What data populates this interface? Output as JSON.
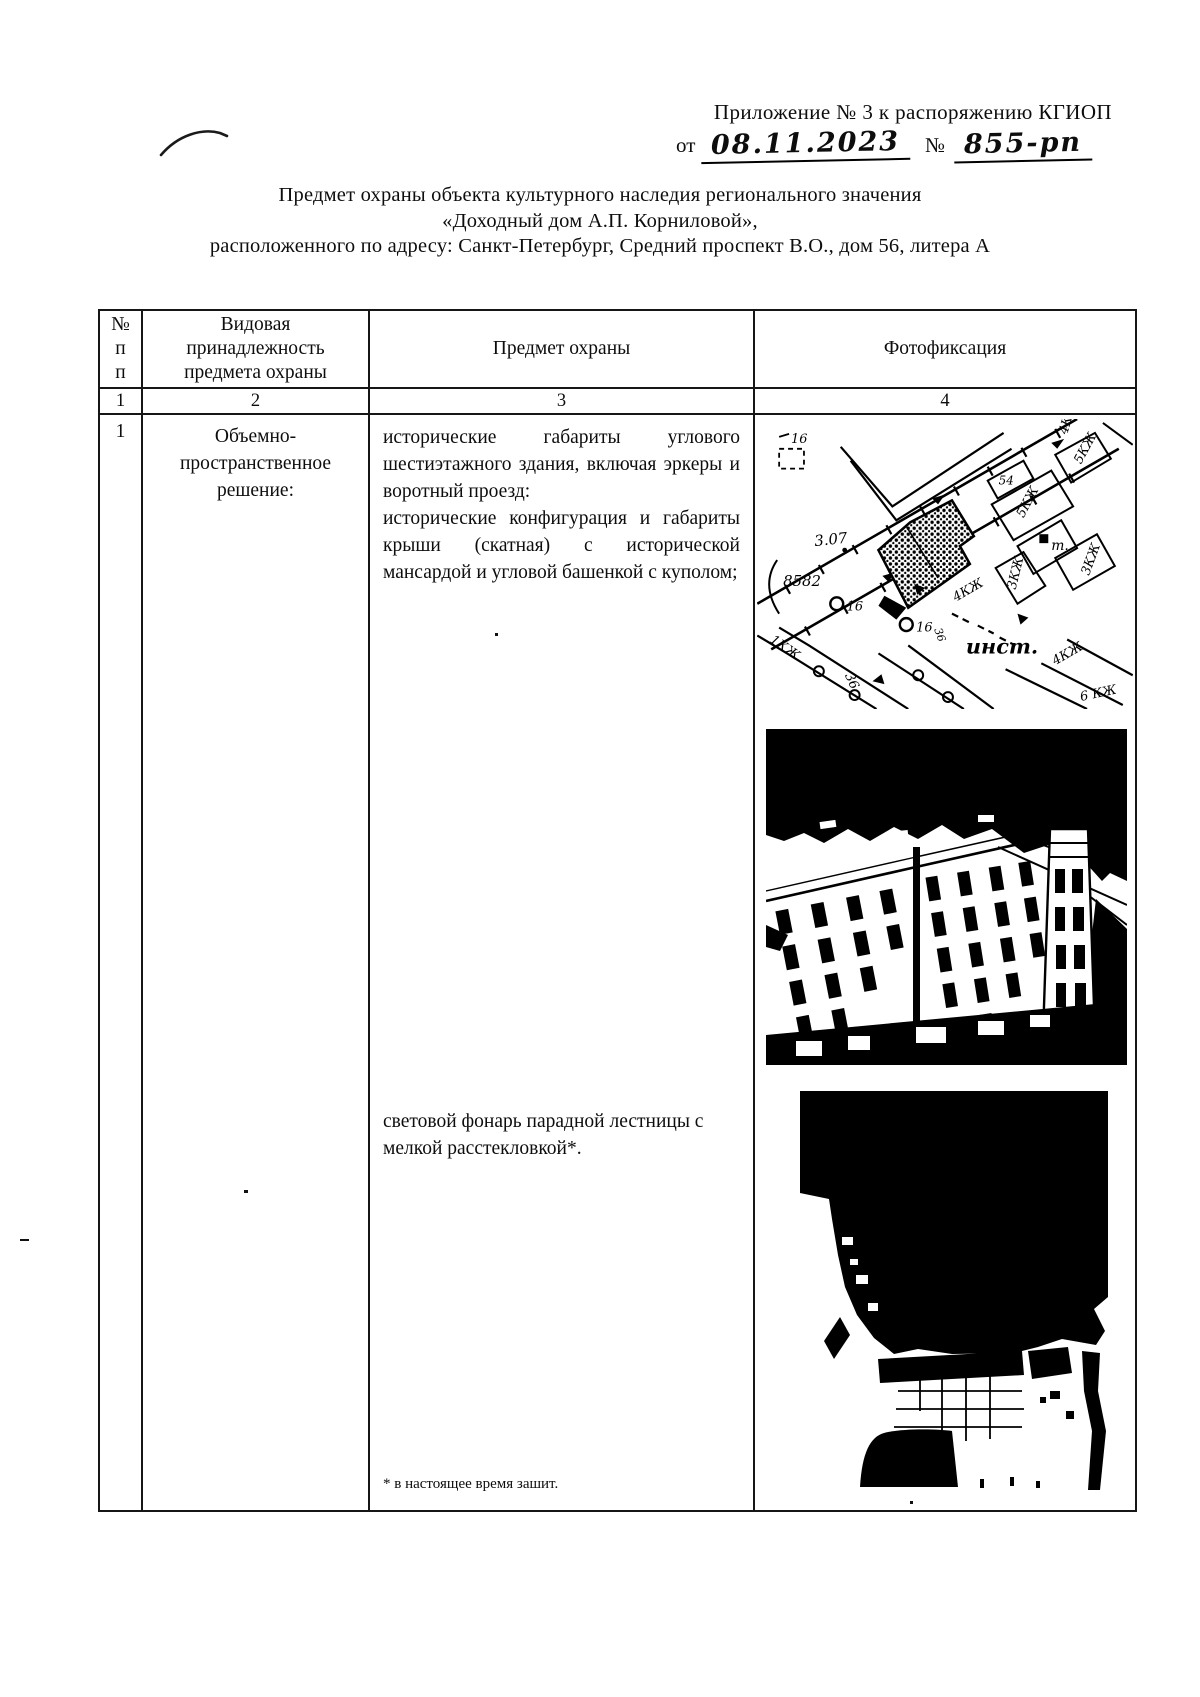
{
  "document": {
    "annex": "Приложение № 3 к распоряжению КГИОП",
    "from_label": "от",
    "date": "08.11.2023",
    "no_sign": "№",
    "number": "855-рп",
    "title_lines": [
      "Предмет охраны объекта культурного наследия регионального значения",
      "«Доходный дом А.П. Корниловой»,",
      "расположенного по адресу: Санкт-Петербург, Средний проспект В.О., дом 56, литера А"
    ]
  },
  "table": {
    "header": {
      "num_lines": [
        "№",
        "п",
        "п"
      ],
      "category_lines": [
        "Видовая",
        "принадлежность",
        "предмета охраны"
      ],
      "subject": "Предмет охраны",
      "photo": "Фотофиксация"
    },
    "column_numbers": [
      "1",
      "2",
      "3",
      "4"
    ],
    "rows": [
      {
        "num": "1",
        "category": "Объемно-пространственное решение:",
        "items": [
          "исторические габариты углового шестиэтажного здания, включая эркеры и воротный проезд:",
          "исторические конфигурация и габариты крыши (скатная) с исторической мансардой и угловой башенкой с куполом;",
          "световой фонарь парадной лестницы с мелкой расстекловкой*."
        ],
        "footnote": "* в настоящее время зашит."
      }
    ]
  },
  "figures": {
    "map_labels": [
      "16",
      "8582",
      "3.07",
      "54",
      "5КЖ",
      "5КЖ",
      "т.",
      "3КЖ",
      "3КЖ",
      "4КЖ",
      "инст.",
      "16",
      "16",
      "36",
      "36",
      "1КЖ",
      "4КЖ",
      "6 КЖ",
      "4КЖ"
    ]
  }
}
